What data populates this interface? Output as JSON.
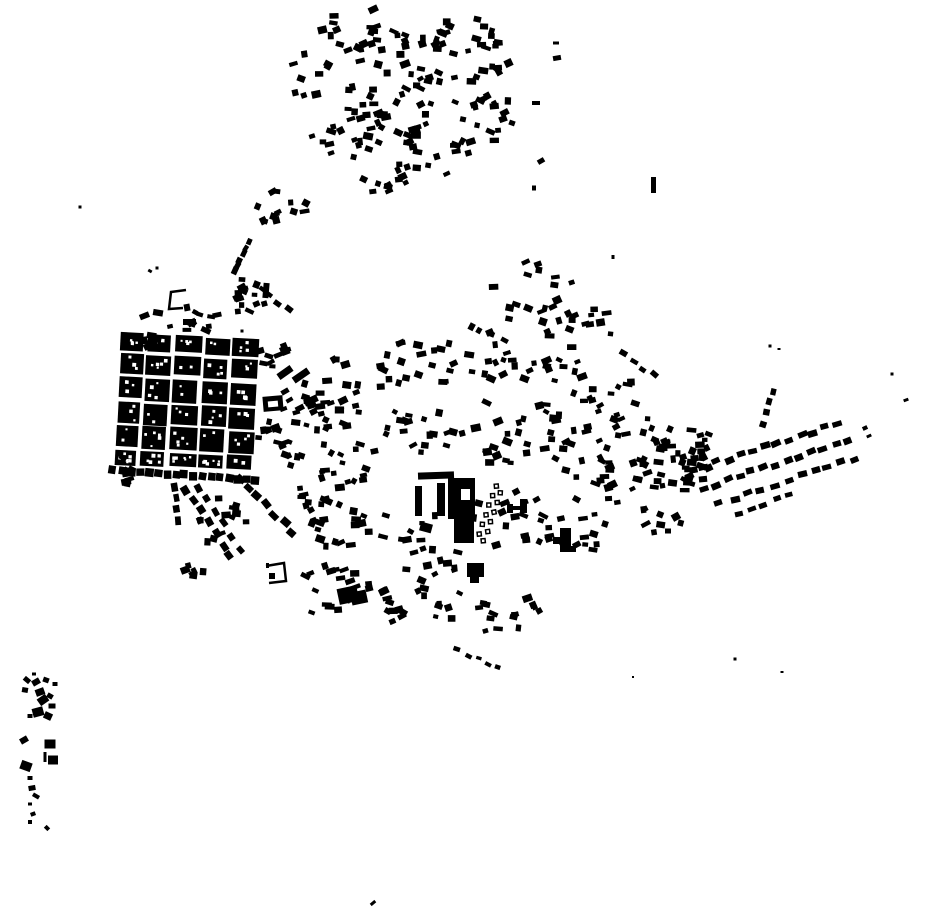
{
  "map": {
    "description": "Black-and-white figure-ground map of building footprints (no text, no labels)",
    "width": 930,
    "height": 924,
    "background_color": "#ffffff",
    "building_color": "#000000",
    "hole_color": "#ffffff",
    "seed": 1337,
    "old_town": {
      "x": 118,
      "y": 336,
      "rotation": 3,
      "pivot": [
        185,
        400
      ],
      "col_widths": [
        22,
        24,
        26,
        24,
        26
      ],
      "col_gap": 4,
      "row_heights": [
        18,
        20,
        22,
        20,
        22,
        14
      ],
      "row_gap": 3,
      "holes_per_block_min": 2,
      "holes_per_block_max": 6,
      "hole_size_min": 2,
      "hole_size_max": 4
    },
    "clusters": [
      [
        365,
        35,
        45,
        28,
        24
      ],
      [
        445,
        48,
        55,
        38,
        28
      ],
      [
        390,
        95,
        50,
        33,
        24
      ],
      [
        468,
        110,
        45,
        38,
        22
      ],
      [
        350,
        140,
        40,
        33,
        18
      ],
      [
        425,
        155,
        45,
        33,
        22
      ],
      [
        312,
        75,
        25,
        28,
        9
      ],
      [
        500,
        55,
        22,
        25,
        8
      ],
      [
        380,
        185,
        30,
        18,
        9
      ],
      [
        287,
        207,
        33,
        20,
        13
      ],
      [
        250,
        297,
        26,
        20,
        14
      ],
      [
        270,
        350,
        17,
        25,
        10
      ],
      [
        268,
        430,
        14,
        18,
        8
      ],
      [
        293,
        452,
        14,
        16,
        8
      ],
      [
        185,
        321,
        52,
        11,
        12
      ],
      [
        149,
        339,
        13,
        9,
        5
      ],
      [
        125,
        470,
        10,
        16,
        7
      ],
      [
        225,
        525,
        30,
        28,
        13
      ],
      [
        195,
        567,
        16,
        12,
        6
      ],
      [
        540,
        300,
        55,
        40,
        24
      ],
      [
        592,
        330,
        32,
        26,
        9
      ],
      [
        308,
        398,
        18,
        38,
        9
      ],
      [
        335,
        390,
        38,
        32,
        20
      ],
      [
        410,
        368,
        45,
        28,
        20
      ],
      [
        490,
        352,
        45,
        28,
        18
      ],
      [
        560,
        390,
        45,
        33,
        20
      ],
      [
        620,
        412,
        42,
        33,
        20
      ],
      [
        680,
        442,
        33,
        28,
        14
      ],
      [
        345,
        455,
        38,
        33,
        20
      ],
      [
        420,
        432,
        38,
        28,
        18
      ],
      [
        500,
        432,
        38,
        33,
        18
      ],
      [
        580,
        452,
        38,
        33,
        18
      ],
      [
        640,
        482,
        38,
        28,
        16
      ],
      [
        350,
        520,
        42,
        38,
        20
      ],
      [
        430,
        548,
        42,
        33,
        18
      ],
      [
        510,
        522,
        38,
        33,
        16
      ],
      [
        575,
        532,
        33,
        28,
        12
      ],
      [
        330,
        588,
        38,
        28,
        16
      ],
      [
        400,
        602,
        42,
        28,
        16
      ],
      [
        470,
        612,
        38,
        26,
        12
      ],
      [
        520,
        613,
        20,
        16,
        8
      ],
      [
        600,
        502,
        28,
        24,
        9
      ],
      [
        660,
        520,
        22,
        18,
        7
      ],
      [
        700,
        478,
        20,
        24,
        8
      ],
      [
        676,
        466,
        20,
        32,
        11
      ],
      [
        697,
        440,
        13,
        13,
        5
      ],
      [
        315,
        495,
        22,
        22,
        11
      ]
    ],
    "rows": [
      [
        113,
        470,
        256,
        480,
        17,
        8,
        8,
        1
      ],
      [
        186,
        489,
        230,
        556,
        7,
        9,
        7,
        2
      ],
      [
        198,
        487,
        240,
        548,
        6,
        8,
        6,
        2
      ],
      [
        240,
        479,
        293,
        532,
        7,
        9,
        7,
        2
      ],
      [
        175,
        487,
        178,
        520,
        4,
        8,
        6,
        1
      ],
      [
        251,
        241,
        233,
        272,
        6,
        7,
        5,
        2
      ],
      [
        262,
        288,
        288,
        310,
        4,
        7,
        5,
        2
      ],
      [
        622,
        352,
        655,
        376,
        4,
        7,
        5,
        2
      ],
      [
        692,
        470,
        838,
        424,
        13,
        9,
        6,
        2
      ],
      [
        703,
        488,
        848,
        441,
        13,
        9,
        6,
        2
      ],
      [
        720,
        503,
        855,
        458,
        11,
        9,
        6,
        2
      ],
      [
        737,
        513,
        790,
        496,
        5,
        8,
        5,
        2
      ],
      [
        763,
        424,
        773,
        391,
        4,
        7,
        6,
        1
      ],
      [
        458,
        651,
        499,
        667,
        5,
        6,
        4,
        2
      ]
    ],
    "hamlet": [
      [
        34,
        674,
        4,
        3,
        0
      ],
      [
        27,
        680,
        7,
        5,
        40
      ],
      [
        36,
        682,
        8,
        6,
        -30
      ],
      [
        46,
        680,
        6,
        5,
        20
      ],
      [
        55,
        684,
        5,
        4,
        0
      ],
      [
        25,
        690,
        6,
        5,
        10
      ],
      [
        40,
        692,
        9,
        7,
        -20
      ],
      [
        50,
        696,
        6,
        5,
        30
      ],
      [
        43,
        700,
        10,
        8,
        -35
      ],
      [
        52,
        706,
        7,
        5,
        0
      ],
      [
        38,
        712,
        11,
        9,
        -15
      ],
      [
        48,
        716,
        8,
        7,
        25
      ],
      [
        30,
        716,
        5,
        4,
        0
      ],
      [
        24,
        740,
        8,
        6,
        -30
      ],
      [
        50,
        744,
        11,
        9,
        0
      ],
      [
        45,
        757,
        3,
        10,
        0
      ],
      [
        53,
        760,
        10,
        9,
        0
      ],
      [
        26,
        766,
        11,
        9,
        20
      ],
      [
        30,
        778,
        5,
        4,
        0
      ],
      [
        32,
        788,
        7,
        5,
        -10
      ],
      [
        36,
        796,
        7,
        4,
        30
      ],
      [
        30,
        804,
        4,
        3,
        0
      ],
      [
        33,
        814,
        5,
        4,
        -20
      ],
      [
        30,
        822,
        4,
        4,
        0
      ],
      [
        47,
        828,
        5,
        4,
        45
      ]
    ],
    "singles": [
      [
        80,
        207,
        3,
        3,
        0
      ],
      [
        150,
        271,
        4,
        3,
        30
      ],
      [
        157,
        268,
        3,
        3,
        0
      ],
      [
        556,
        43,
        6,
        3,
        0
      ],
      [
        557,
        58,
        8,
        5,
        -10
      ],
      [
        536,
        103,
        8,
        4,
        0
      ],
      [
        503,
        119,
        8,
        6,
        -20
      ],
      [
        512,
        123,
        6,
        5,
        20
      ],
      [
        541,
        161,
        7,
        5,
        -30
      ],
      [
        534,
        188,
        4,
        5,
        0
      ],
      [
        613,
        257,
        3,
        4,
        0
      ],
      [
        892,
        374,
        3,
        3,
        0
      ],
      [
        906,
        400,
        5,
        3,
        -20
      ],
      [
        770,
        346,
        3,
        3,
        0
      ],
      [
        779,
        349,
        3,
        2,
        0
      ],
      [
        735,
        659,
        3,
        3,
        0
      ],
      [
        782,
        672,
        3,
        2,
        0
      ],
      [
        633,
        677,
        2,
        2,
        0
      ],
      [
        373,
        903,
        6,
        3,
        -40
      ],
      [
        668,
        531,
        6,
        5,
        0
      ],
      [
        865,
        428,
        5,
        4,
        -25
      ],
      [
        869,
        436,
        5,
        3,
        -25
      ],
      [
        242,
        331,
        3,
        3,
        0
      ]
    ],
    "landmark_rects": [
      [
        418,
        472,
        36,
        7,
        -2
      ],
      [
        415,
        486,
        7,
        30,
        0
      ],
      [
        437,
        483,
        8,
        33,
        0
      ],
      [
        448,
        478,
        27,
        41,
        0
      ],
      [
        454,
        519,
        20,
        24,
        0
      ],
      [
        420,
        523,
        12,
        9,
        15
      ],
      [
        507,
        504,
        6,
        9,
        0
      ],
      [
        512,
        506,
        9,
        4,
        0
      ],
      [
        520,
        499,
        7,
        14,
        0
      ],
      [
        560,
        528,
        11,
        19,
        0
      ],
      [
        553,
        537,
        8,
        7,
        0
      ],
      [
        560,
        546,
        16,
        6,
        0
      ],
      [
        338,
        587,
        20,
        16,
        -12
      ],
      [
        351,
        591,
        16,
        13,
        -12
      ],
      [
        467,
        563,
        17,
        14,
        0
      ],
      [
        470,
        577,
        9,
        6,
        0
      ],
      [
        263,
        396,
        20,
        15,
        -5
      ],
      [
        277,
        369,
        16,
        7,
        -35
      ],
      [
        651,
        177,
        5,
        16,
        0
      ],
      [
        292,
        372,
        18,
        7,
        -35
      ],
      [
        304,
        397,
        14,
        7,
        -25
      ],
      [
        281,
        389,
        8,
        5,
        -30
      ],
      [
        286,
        398,
        7,
        4,
        -30
      ],
      [
        280,
        407,
        7,
        4,
        -20
      ],
      [
        263,
        283,
        6,
        15,
        5
      ],
      [
        183,
        319,
        13,
        6,
        0
      ],
      [
        184,
        304,
        6,
        7,
        -10
      ],
      [
        266,
        563,
        3,
        5,
        0
      ],
      [
        269,
        573,
        6,
        6,
        0
      ]
    ],
    "landmark_holes": [
      [
        461,
        489,
        9,
        11,
        0
      ],
      [
        268,
        401,
        10,
        6,
        -5
      ]
    ],
    "courtyards": [
      {
        "points": [
          [
            186,
            290
          ],
          [
            171,
            292
          ],
          [
            169,
            309
          ],
          [
            183,
            308
          ]
        ],
        "stroke_w": 2.5
      },
      {
        "points": [
          [
            266,
            566
          ],
          [
            284,
            563
          ],
          [
            286,
            581
          ],
          [
            269,
            583
          ]
        ],
        "stroke_w": 2.5
      }
    ],
    "checker_band": {
      "x1": 499,
      "y1": 487,
      "x2": 481,
      "y2": 540,
      "count": 12,
      "cell": 5.5,
      "inner": 2.5,
      "stagger": 3.5
    },
    "scatter_size": {
      "w_min": 5,
      "w_max": 10,
      "h_min": 4,
      "h_max": 7.5,
      "rot_spread": 60
    }
  }
}
